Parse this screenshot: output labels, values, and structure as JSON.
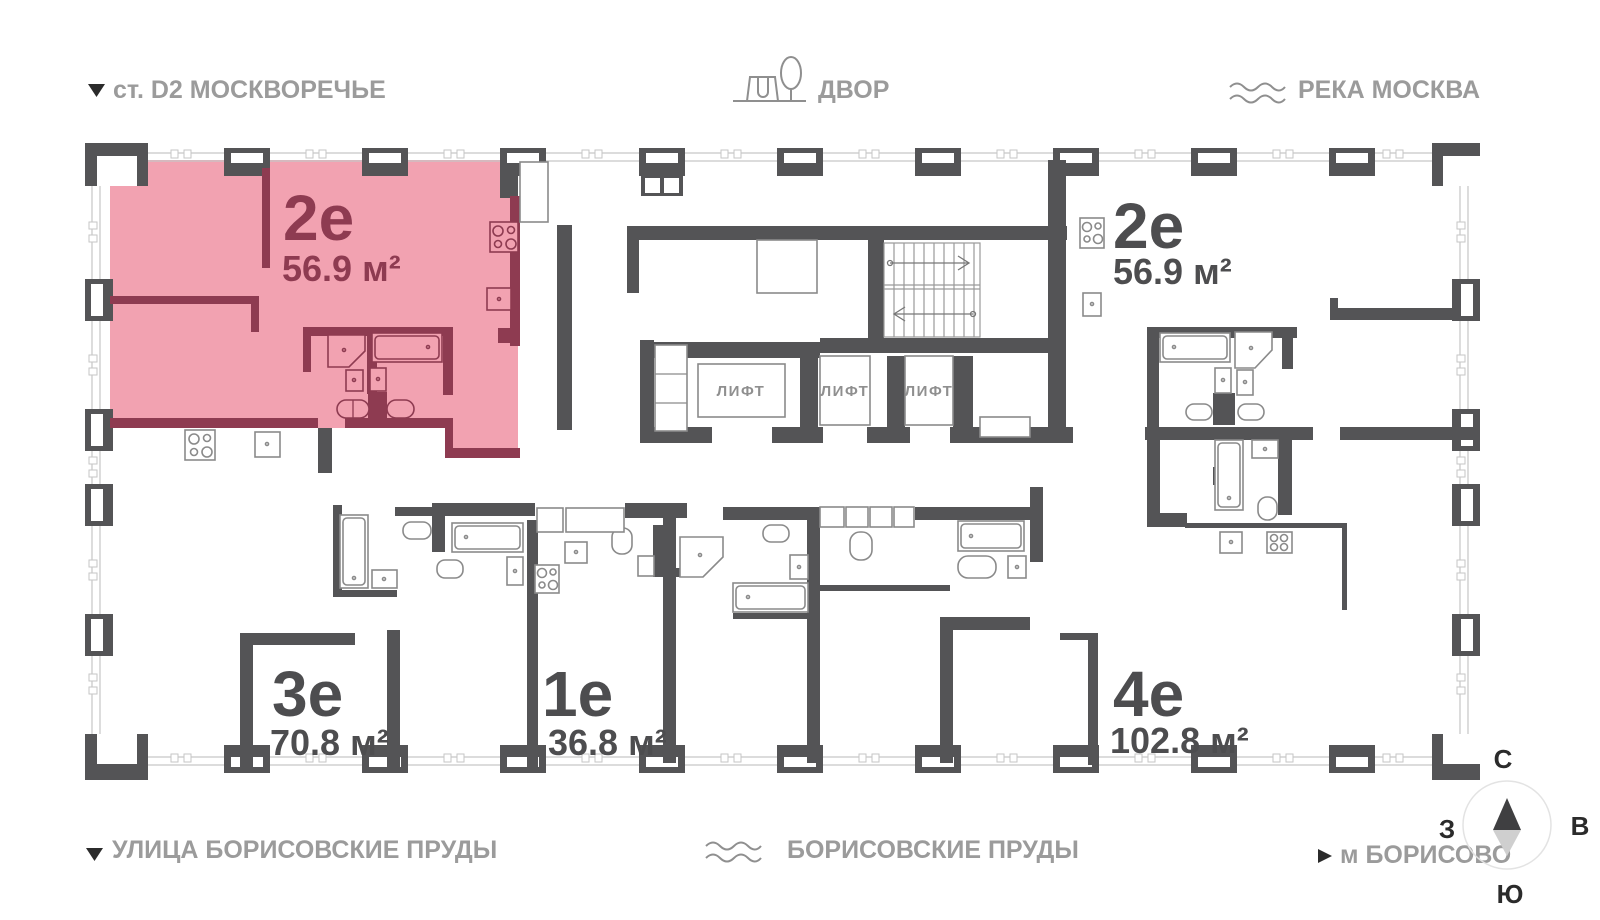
{
  "legend": {
    "top_left": {
      "label": "ст. D2 МОСКВОРЕЧЬЕ"
    },
    "top_center": {
      "label": "ДВОР"
    },
    "top_right": {
      "label": "РЕКА МОСКВА"
    },
    "bottom_left": {
      "label": "УЛИЦА БОРИСОВСКИЕ ПРУДЫ"
    },
    "bottom_center": {
      "label": "БОРИСОВСКИЕ ПРУДЫ"
    },
    "bottom_right": {
      "label": "м БОРИСОВО"
    }
  },
  "apartments": {
    "apt_2e_left": {
      "type": "2е",
      "area": "56.9 м²",
      "highlighted": true
    },
    "apt_2e_right": {
      "type": "2е",
      "area": "56.9 м²",
      "highlighted": false
    },
    "apt_3e": {
      "type": "3е",
      "area": "70.8 м²",
      "highlighted": false
    },
    "apt_1e": {
      "type": "1е",
      "area": "36.8 м²",
      "highlighted": false
    },
    "apt_4e": {
      "type": "4е",
      "area": "102.8 м²",
      "highlighted": false
    }
  },
  "elevator": {
    "label": "ЛИФТ"
  },
  "compass": {
    "north": "С",
    "south": "Ю",
    "west": "З",
    "east": "В"
  },
  "icons": {
    "top_left": "direction-triangle-icon",
    "top_center": "playground-icon",
    "top_right": "river-waves-icon",
    "bottom_center": "pond-waves-icon",
    "bottom_right": "metro-arrow-icon"
  },
  "colors": {
    "highlight_fill": "#F2A2B1",
    "highlight_wall": "#8E3B51",
    "wall": "#545456",
    "legend_text": "#9b9b9b",
    "label_text": "#4D4D4F",
    "glazing": "#c6c6c6"
  }
}
